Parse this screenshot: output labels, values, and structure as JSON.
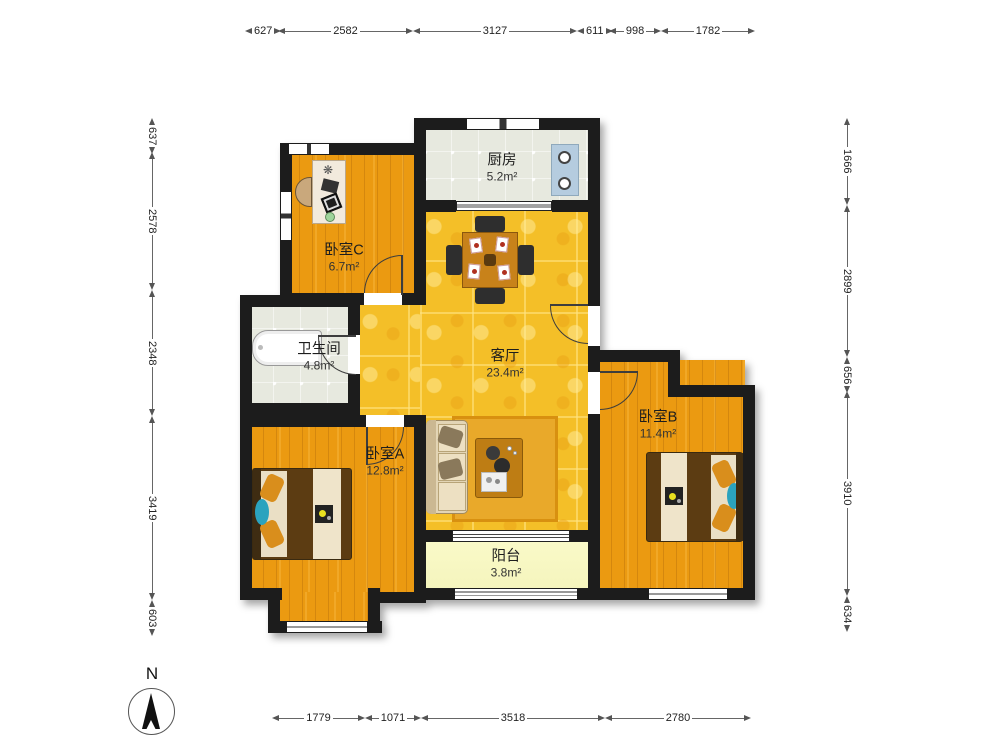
{
  "compass": {
    "label": "N"
  },
  "rooms": [
    {
      "id": "kitchen",
      "name": "厨房",
      "area": "5.2m²"
    },
    {
      "id": "bedroomC",
      "name": "卧室C",
      "area": "6.7m²"
    },
    {
      "id": "bathroom",
      "name": "卫生间",
      "area": "4.8m²"
    },
    {
      "id": "living",
      "name": "客厅",
      "area": "23.4m²"
    },
    {
      "id": "bedroomA",
      "name": "卧室A",
      "area": "12.8m²"
    },
    {
      "id": "bedroomB",
      "name": "卧室B",
      "area": "11.4m²"
    },
    {
      "id": "balcony",
      "name": "阳台",
      "area": "3.8m²"
    }
  ],
  "dimensions": {
    "top": [
      "627",
      "2582",
      "3127",
      "611",
      "998",
      "1782"
    ],
    "left": [
      "637",
      "2578",
      "2348",
      "3419",
      "603"
    ],
    "right": [
      "1666",
      "2899",
      "656",
      "3910",
      "634"
    ],
    "bottom": [
      "1779",
      "1071",
      "3518",
      "2780"
    ]
  },
  "colors": {
    "wall": "#1c1c1c",
    "wood_floor": "#EB9A11",
    "living_tile": "#F4BF28",
    "kitchen_tile": "#E7E9DF",
    "balcony_floor": "#FAFAC9",
    "stove": "#B5CCDF",
    "accent_teal": "#2BA3BE"
  }
}
